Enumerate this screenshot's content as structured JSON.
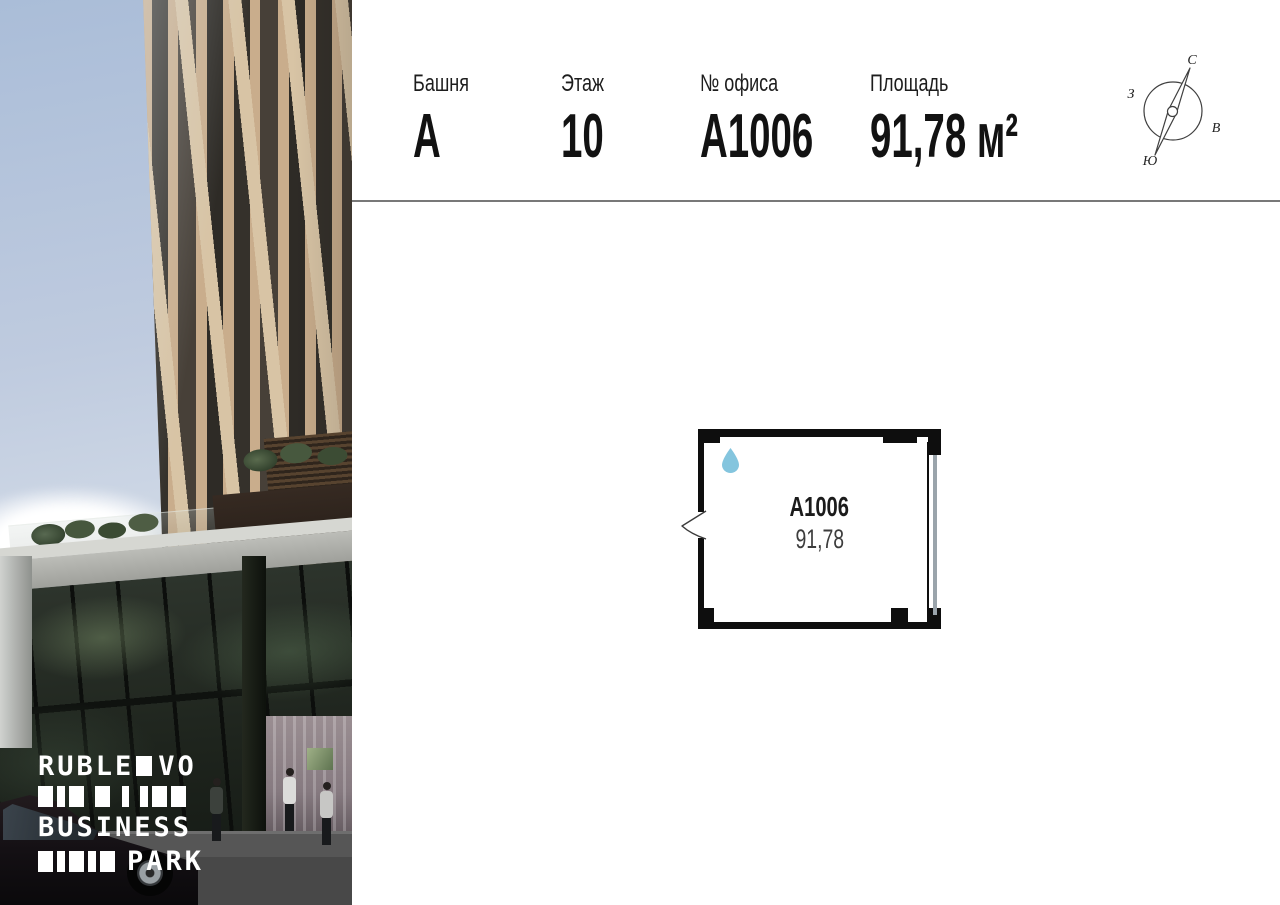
{
  "header": {
    "columns": [
      {
        "label": "Башня",
        "value": "А"
      },
      {
        "label": "Этаж",
        "value": "10"
      },
      {
        "label": "№ офиса",
        "value": "А1006"
      },
      {
        "label": "Площадь",
        "value": "91,78 м²"
      }
    ]
  },
  "compass": {
    "north_label": "С",
    "south_label": "Ю",
    "west_label": "З",
    "east_label": "В"
  },
  "floor_plan": {
    "unit_label": "А1006",
    "area_label": "91,78"
  },
  "logo": {
    "line1_left": "RUBLE",
    "line1_right": "VO",
    "line2": "BUSINESS",
    "line3": "PARK",
    "bars_row1": [
      [
        15,
        4
      ],
      [
        8,
        4
      ],
      [
        15,
        11
      ],
      [
        15,
        12
      ],
      [
        7,
        11
      ],
      [
        8,
        4
      ],
      [
        15,
        4
      ],
      [
        15,
        0
      ]
    ],
    "bars_row2": [
      [
        15,
        4
      ],
      [
        8,
        4
      ],
      [
        15,
        4
      ],
      [
        8,
        4
      ],
      [
        15,
        0
      ]
    ]
  },
  "colors": {
    "water_drop": "#84c5de",
    "plan_wall": "#0e0e0e",
    "plan_window_glass": "#9aa4ab",
    "divider": "#787878",
    "facade_beige": "#c9ad8c",
    "logo_text": "#ffffff"
  }
}
